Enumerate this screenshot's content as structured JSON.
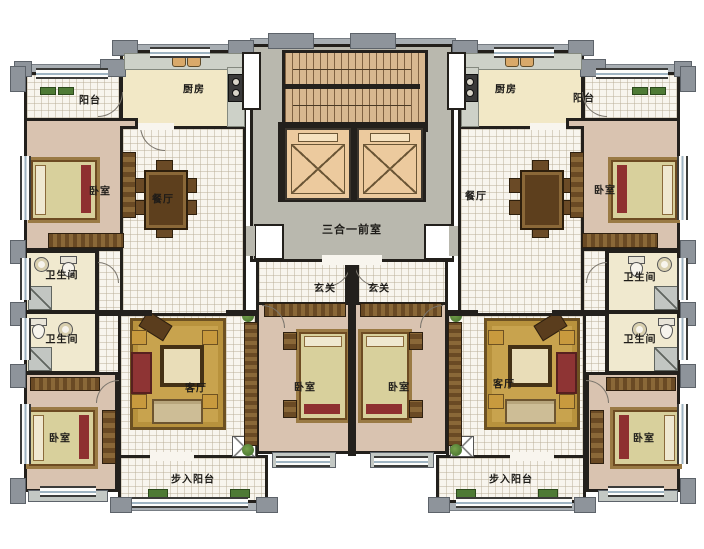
{
  "rooms": [
    {
      "id": "balcony-top-left",
      "label": "阳台"
    },
    {
      "id": "kitchen-left",
      "label": "厨房"
    },
    {
      "id": "bedroom-top-left",
      "label": "卧室"
    },
    {
      "id": "dining-left",
      "label": "餐厅"
    },
    {
      "id": "bath-left-upper",
      "label": "卫生间"
    },
    {
      "id": "bath-left-lower",
      "label": "卫生间"
    },
    {
      "id": "bedroom-bottom-left",
      "label": "卧室"
    },
    {
      "id": "living-left",
      "label": "客厅"
    },
    {
      "id": "walkin-balcony-left",
      "label": "步入阳台"
    },
    {
      "id": "entry-left",
      "label": "玄关"
    },
    {
      "id": "bedroom-center-left",
      "label": "卧室"
    },
    {
      "id": "core-lobby",
      "label": "三合一前室"
    },
    {
      "id": "entry-right",
      "label": "玄关"
    },
    {
      "id": "bedroom-center-right",
      "label": "卧室"
    },
    {
      "id": "living-right",
      "label": "客厅"
    },
    {
      "id": "walkin-balcony-right",
      "label": "步入阳台"
    },
    {
      "id": "dining-right",
      "label": "餐厅"
    },
    {
      "id": "kitchen-right",
      "label": "厨房"
    },
    {
      "id": "balcony-top-right",
      "label": "阳台"
    },
    {
      "id": "bedroom-top-right",
      "label": "卧室"
    },
    {
      "id": "bath-right-upper",
      "label": "卫生间"
    },
    {
      "id": "bath-right-lower",
      "label": "卫生间"
    },
    {
      "id": "bedroom-bottom-right",
      "label": "卧室"
    }
  ],
  "palette": {
    "wall": "#23201c",
    "tile_floor": "#f8f5ee",
    "bedroom_floor": "#d9c3b0",
    "kitchen_floor": "#f2e8c6",
    "bath_floor": "#f0e9cf",
    "lobby_floor": "#b9b8ae",
    "stair": "#d8b890",
    "elevator": "#ecca9e",
    "rug": "#c8a34e",
    "trim_gray": "#a8aeb3",
    "sofa_red": "#8e3434",
    "plant_green": "#4e7a35"
  }
}
